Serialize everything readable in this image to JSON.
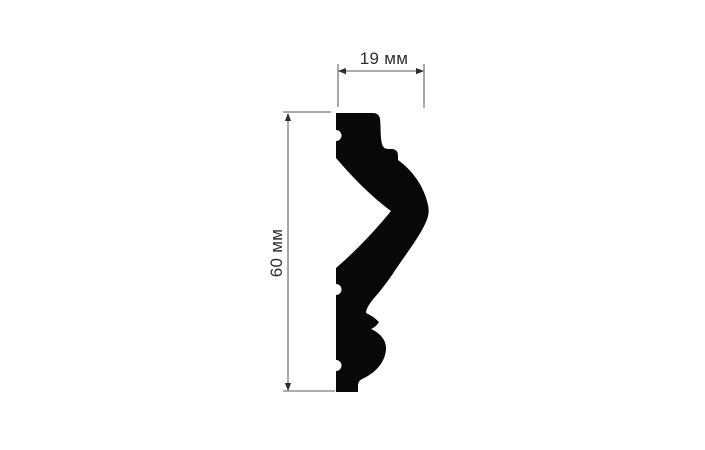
{
  "drawing": {
    "labels": {
      "width": "19 мм",
      "height": "60 мм"
    },
    "dimensions": {
      "width_value": 19,
      "height_value": 60,
      "unit": "мм"
    },
    "colors": {
      "background": "#ffffff",
      "profile": "#080808",
      "dimension_line": "#7a7a7a",
      "arrow": "#2e2e2e",
      "label_text": "#2e2e2e"
    }
  }
}
